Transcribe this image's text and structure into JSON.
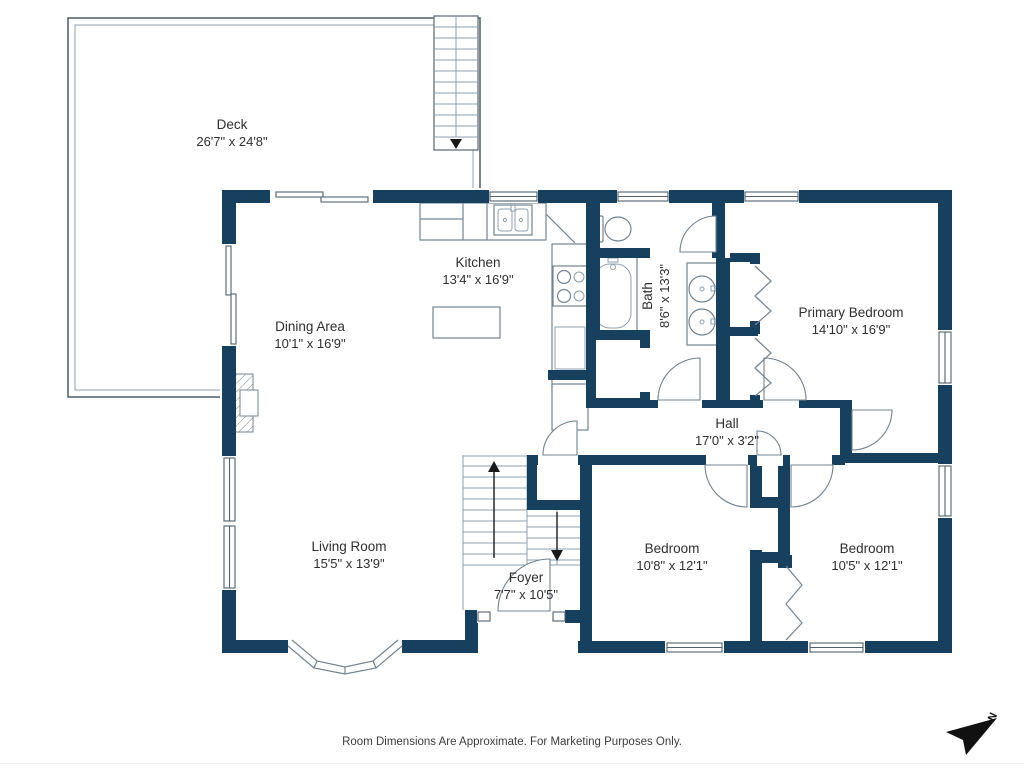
{
  "rooms": {
    "deck": {
      "name": "Deck",
      "dims": "26'7\" x 24'8\""
    },
    "kitchen": {
      "name": "Kitchen",
      "dims": "13'4\" x 16'9\""
    },
    "dining": {
      "name": "Dining Area",
      "dims": "10'1\" x 16'9\""
    },
    "living": {
      "name": "Living Room",
      "dims": "15'5\" x 13'9\""
    },
    "foyer": {
      "name": "Foyer",
      "dims": "7'7\" x 10'5\""
    },
    "hall": {
      "name": "Hall",
      "dims": "17'0\" x 3'2\""
    },
    "bath": {
      "name": "Bath",
      "dims": "8'6\" x 13'3\""
    },
    "primary": {
      "name": "Primary Bedroom",
      "dims": "14'10\" x 16'9\""
    },
    "bedroom1": {
      "name": "Bedroom",
      "dims": "10'8\" x 12'1\""
    },
    "bedroom2": {
      "name": "Bedroom",
      "dims": "10'5\" x 12'1\""
    }
  },
  "footer": {
    "disclaimer": "Room Dimensions Are Approximate. For Marketing Purposes Only."
  },
  "compass": {
    "north_label": "N"
  },
  "colors": {
    "wall": "#17405f",
    "line": "#74838f",
    "text": "#2f2f2f",
    "footer": "#3d3d3d"
  }
}
